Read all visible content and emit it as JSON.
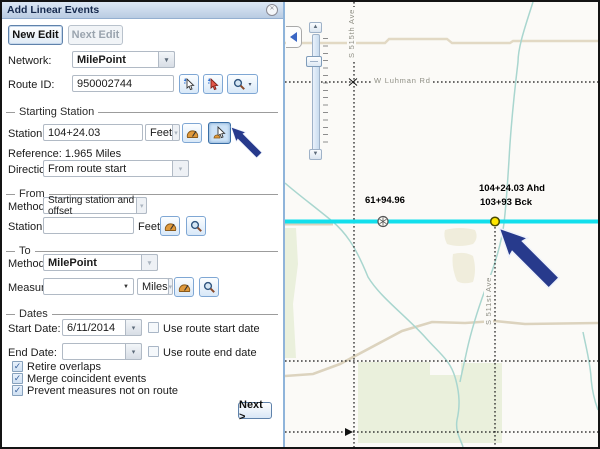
{
  "panel": {
    "title": "Add Linear Events",
    "edit_buttons": {
      "new_edit": "New Edit",
      "next_edit": "Next Edit"
    },
    "fields": {
      "network": {
        "label": "Network:",
        "value": "MilePoint"
      },
      "route_id": {
        "label": "Route ID:",
        "value": "950002744"
      }
    },
    "starting_station": {
      "legend": "Starting Station",
      "station": {
        "label": "Station:",
        "value": "104+24.03",
        "units": "Feet"
      },
      "reference": "Reference: 1.965 Miles",
      "direction": {
        "label": "Direction:",
        "value": "From route start"
      }
    },
    "from": {
      "legend": "From",
      "method": {
        "label": "Method:",
        "value": "Starting station and offset"
      },
      "station": {
        "label": "Station:",
        "value": "",
        "units": "Feet"
      }
    },
    "to": {
      "legend": "To",
      "method": {
        "label": "Method:",
        "value": "MilePoint"
      },
      "measure": {
        "label": "Measure:",
        "value": "",
        "units": "Miles"
      }
    },
    "dates": {
      "legend": "Dates",
      "start": {
        "label": "Start Date:",
        "value": "6/11/2014",
        "checkbox_label": "Use route start date",
        "checked": false
      },
      "end": {
        "label": "End Date:",
        "value": "",
        "checkbox_label": "Use route end date",
        "checked": false
      }
    },
    "options": [
      {
        "label": "Retire overlaps",
        "checked": true
      },
      {
        "label": "Merge coincident events",
        "checked": true
      },
      {
        "label": "Prevent measures not on route",
        "checked": true
      }
    ],
    "next_button": "Next >"
  },
  "map": {
    "road_labels": {
      "horizontal": "W Luhman Rd",
      "vertical_top": "S 515th Ave",
      "vertical_right": "S 511st Ave"
    },
    "station_labels": {
      "point1": "61+94.96",
      "point2_ahead": "104+24.03 Ahd",
      "point2_back": "103+93 Bck"
    },
    "colors": {
      "route": "#12dfec",
      "selected_point": "#ffe600",
      "stream": "#a9d6cf",
      "road_tan": "#ded6c1",
      "land_green": "#eaf0dc",
      "annotation_arrow": "#273a8c"
    }
  },
  "icons": {
    "dropdown": "▾",
    "combo_caret": "▼",
    "slider_up": "▲",
    "slider_down": "▼",
    "check": "✓",
    "close": "✕"
  }
}
